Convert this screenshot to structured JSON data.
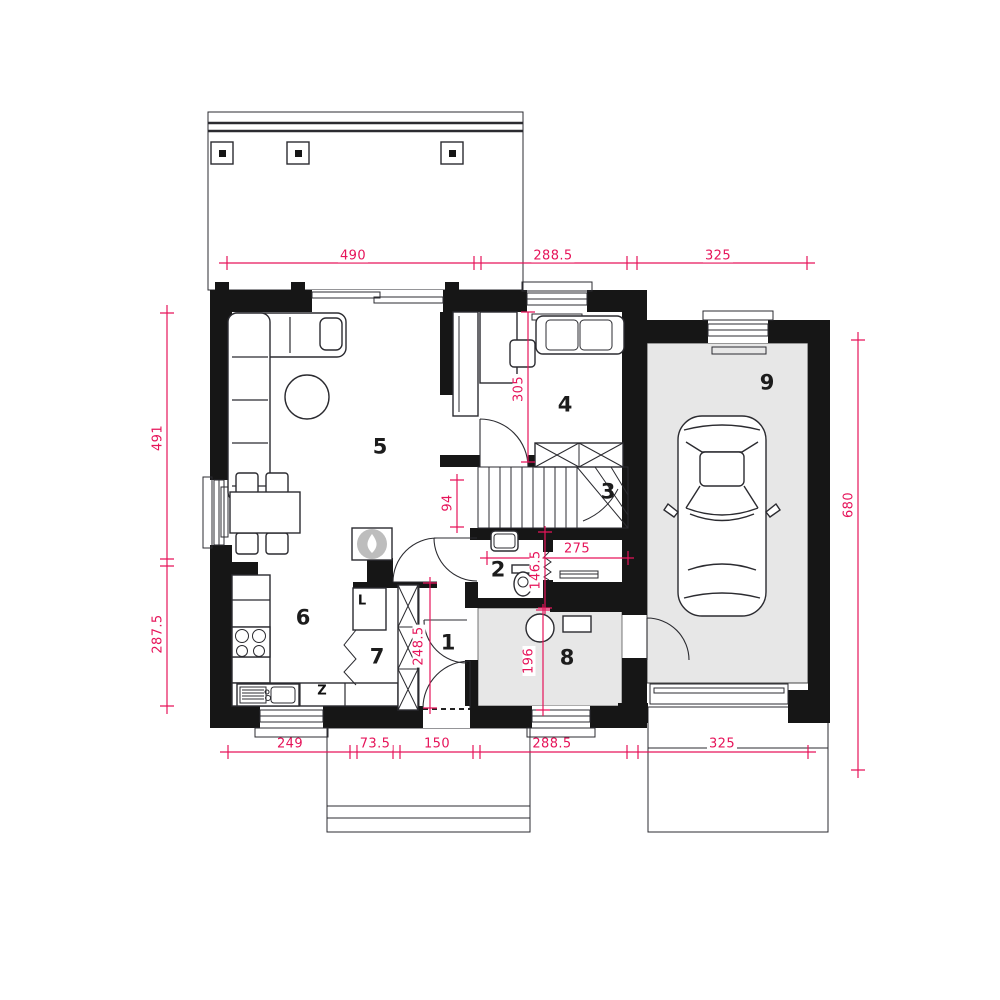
{
  "plan_type": "floor-plan",
  "room_numbers": [
    "1",
    "2",
    "3",
    "4",
    "5",
    "6",
    "7",
    "8",
    "9"
  ],
  "appliance_labels": {
    "fridge": "L",
    "appliance_z": "Z"
  },
  "dimensions": {
    "top": [
      "490",
      "288.5",
      "325"
    ],
    "bottom": [
      "249",
      "73.5",
      "150",
      "288.5",
      "325"
    ],
    "left": [
      "491",
      "287.5"
    ],
    "right": [
      "680"
    ],
    "interior": {
      "room4_height": "305",
      "stair_width": "94",
      "corridor_width": "275",
      "wc_height": "146.5",
      "utility_height": "196",
      "hall_height": "248.5"
    }
  },
  "colors": {
    "dimension_red": "#e6145a",
    "wall_black": "#161616",
    "floor_gray": "#e7e7e7",
    "fireplace_gray": "#bdbdbd",
    "line_dark": "#2b2b30"
  }
}
